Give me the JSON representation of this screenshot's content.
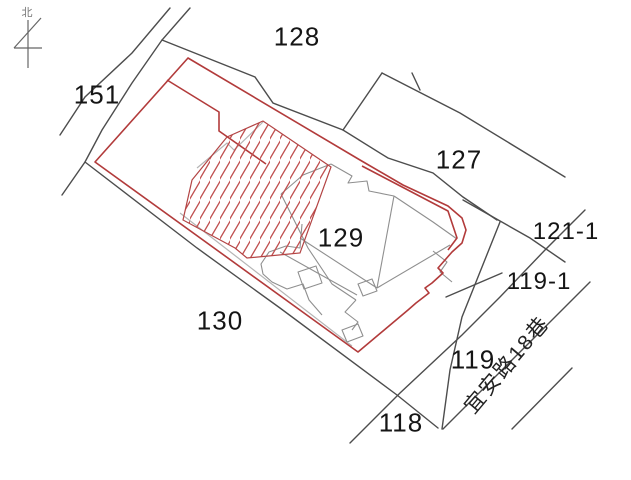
{
  "map": {
    "type": "cadastral-parcel-map",
    "parcel_labels": {
      "p128": "128",
      "p151": "151",
      "p127": "127",
      "p129": "129",
      "p130": "130",
      "p121_1": "121-1",
      "p119_1": "119-1",
      "p119": "119",
      "p118": "118"
    },
    "road": {
      "name": "宜安路18巷"
    },
    "north": {
      "label": "北"
    },
    "colors": {
      "background": "#ffffff",
      "parcel_boundary": "#4d4d4d",
      "building_outline_red": "#b23b3b",
      "hatch_red": "#c05050",
      "survey_gray": "#8f8f8f",
      "light_gray": "#b5b5b5",
      "label_text": "#151515"
    }
  }
}
